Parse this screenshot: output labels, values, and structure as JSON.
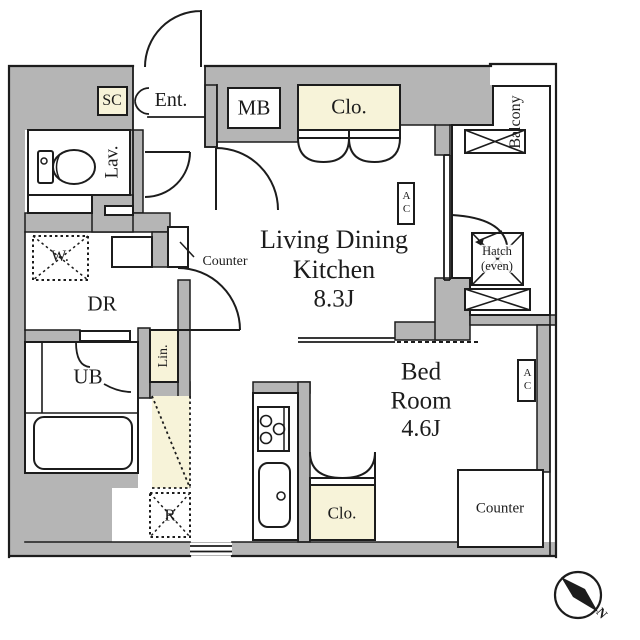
{
  "colors": {
    "wall": "#b5b5b5",
    "cream": "#f7f3d9",
    "line": "#1c1c1c",
    "floor": "#ffffff"
  },
  "labels": {
    "shoe_closet": "SC",
    "entrance": "Ent.",
    "meter_box": "MB",
    "closet_ldk": "Clo.",
    "lavatory": "Lav.",
    "washer": "W.",
    "counter_ldk": "Counter",
    "dressing_room": "DR",
    "ldk_line1": "Living Dining",
    "ldk_line2": "Kitchen",
    "ldk_size": "8.3J",
    "linen": "Lin.",
    "unit_bath": "UB",
    "refrigerator": "R",
    "bedroom_line1": "Bed",
    "bedroom_line2": "Room",
    "bedroom_size": "4.6J",
    "closet_bedroom": "Clo.",
    "counter_bedroom": "Counter",
    "balcony": "Balcony",
    "hatch_line1": "Hatch",
    "hatch_line2": "(even)",
    "ac": "AC",
    "north": "N"
  }
}
